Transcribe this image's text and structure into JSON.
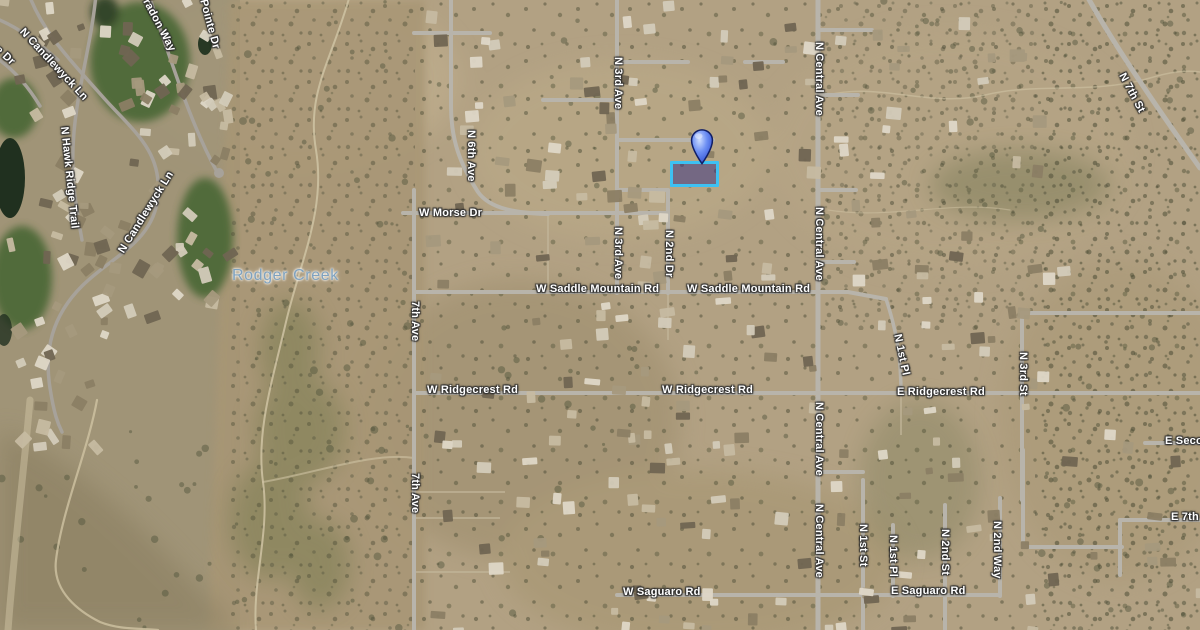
{
  "map": {
    "view": "satellite",
    "place_labels": {
      "rodger_creek": "Rodger Creek"
    },
    "street_labels": {
      "w_morse_dr": "W Morse Dr",
      "w_saddle_mountain_rd": "W Saddle Mountain Rd",
      "w_ridgecrest_rd": "W Ridgecrest Rd",
      "e_ridgecrest_rd": "E Ridgecrest Rd",
      "w_saguaro_rd": "W Saguaro Rd",
      "e_saguaro_rd": "E Saguaro Rd",
      "n_central_ave": "N Central Ave",
      "n_3rd_ave": "N 3rd Ave",
      "n_2nd_dr": "N 2nd Dr",
      "n_6th_ave": "N 6th Ave",
      "seventh_ave": "7th Ave",
      "n_7th_st": "N 7th St",
      "n_3rd_st": "N 3rd St",
      "n_1st_pl": "N 1st Pl",
      "n_1st_st": "N 1st St",
      "n_2nd_st": "N 2nd St",
      "n_2nd_way": "N 2nd Way",
      "e_second_st": "E Second St",
      "e_7th_st": "E 7th St",
      "n_candlewyck_ln": "N Candlewyck Ln",
      "n_hawk_ridge_trail": "N Hawk Ridge Trail",
      "pointe_dr": "Pointe Dr",
      "radon_way": "radon Way",
      "ge_dr": "ge Dr"
    },
    "marker": {
      "type": "location-pin",
      "color": "#2a49cf"
    },
    "parcel_highlight": {
      "border_color": "#3ec1f2",
      "fill_color": "rgba(56,48,130,0.52)"
    }
  }
}
